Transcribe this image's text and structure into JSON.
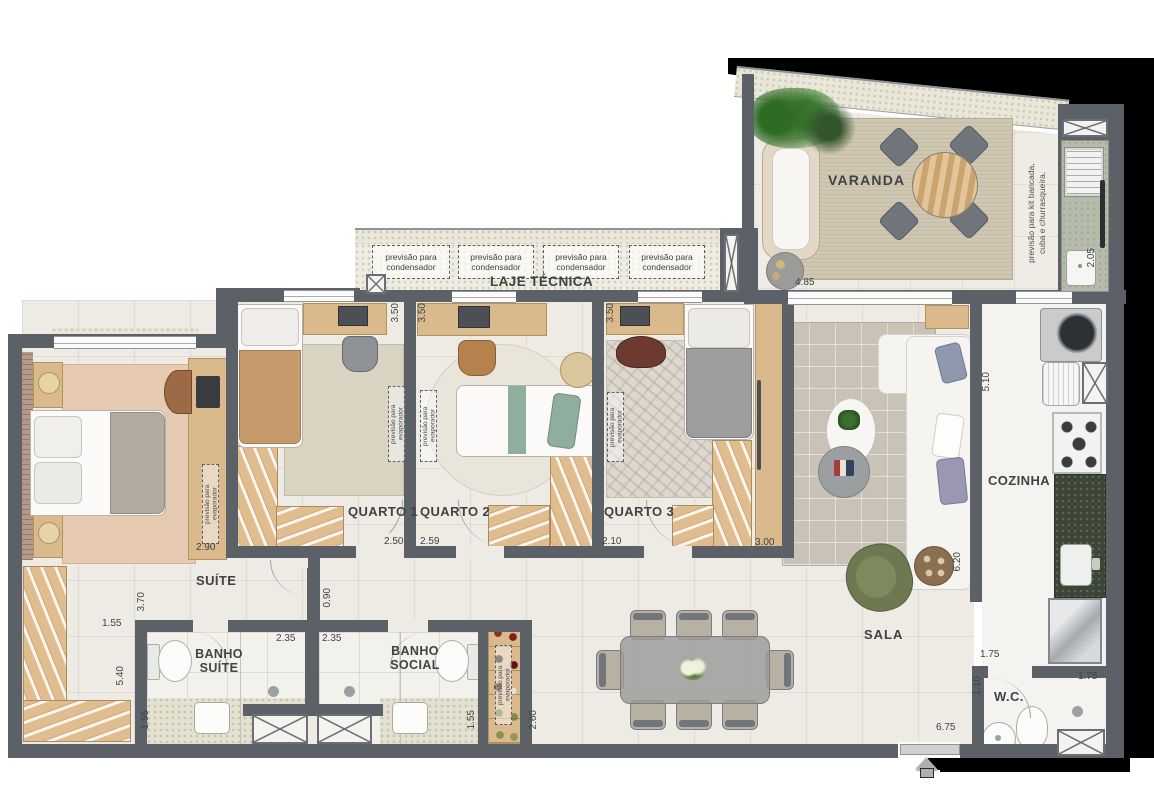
{
  "plan_title": "apartment floor plan",
  "rooms": {
    "varanda": {
      "label": "VARANDA"
    },
    "laje_tecnica": {
      "label": "LAJE TÉCNICA"
    },
    "suite": {
      "label": "SUÍTE"
    },
    "quarto1": {
      "label": "QUARTO 1"
    },
    "quarto2": {
      "label": "QUARTO 2"
    },
    "quarto3": {
      "label": "QUARTO 3"
    },
    "sala": {
      "label": "SALA"
    },
    "cozinha": {
      "label": "COZINHA"
    },
    "wc": {
      "label": "W.C."
    },
    "banho_suite": {
      "line1": "BANHO",
      "line2": "SUÍTE"
    },
    "banho_social": {
      "line1": "BANHO",
      "line2": "SOCIAL"
    }
  },
  "notes": {
    "condensador_l1": "previsão para",
    "condensador_l2": "condensador",
    "kit_l1": "previsão para kit bancada,",
    "kit_l2": "cuba e churrasqueira.",
    "evaporador": "previsão para evaporador"
  },
  "dimensions": {
    "varanda_width": "4.85",
    "varanda_depth": "2.05",
    "quarto1_depth": "3.50",
    "quarto2_depth": "3.50",
    "quarto3_depth": "3.50",
    "suite_width": "2.90",
    "quarto1_width": "2.50",
    "quarto2_width": "2.59",
    "quarto3_width": "2.10",
    "quarto3_closet": "3.00",
    "cozinha_depth": "5.10",
    "sala_depth": "6.20",
    "suite_depth": "3.70",
    "suite_closet_width": "1.55",
    "suite_closet_depth": "5.40",
    "hall_width": "0.90",
    "banho_suite_width": "2.35",
    "banho_social_width": "2.35",
    "banho_suite_depth": "1.55",
    "banho_social_depth": "1.55",
    "adega_depth": "2.60",
    "cozinha_passage": "1.75",
    "wc_depth": "1.10",
    "wc_width": "1.75",
    "sala_width": "6.75"
  },
  "colors": {
    "wall": "#5c6167",
    "floor": "#eeebe5",
    "outdoor_speckle": "#eae7d9",
    "counter_granite": "#3c4636",
    "wood": "#dab98d",
    "armchair_green": "#6e7851"
  }
}
